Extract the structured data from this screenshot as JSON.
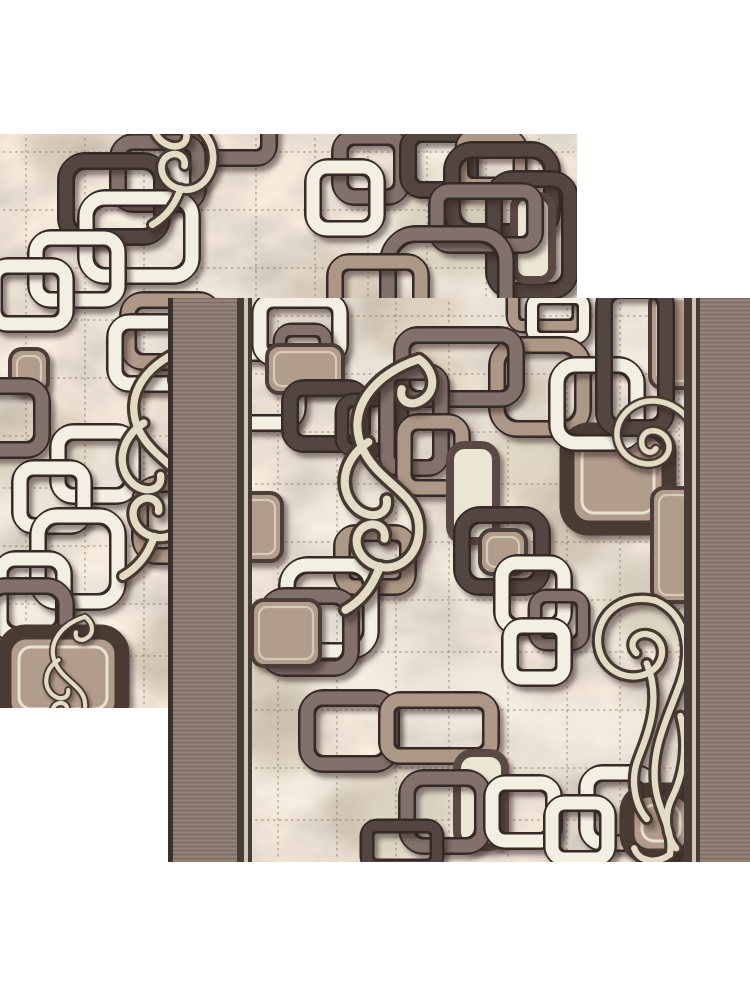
{
  "scene": {
    "description": "Product photo of a beige-brown modern carpet runner shown as two overlapping square swatches on a white background",
    "canvas": {
      "width": 750,
      "height": 1000,
      "background": "#ffffff"
    }
  },
  "palette": {
    "page_bg": "#ffffff",
    "marble_base": "#cfc4ad",
    "marble_light": "#f3efe3",
    "marble_dark": "#b5a88d",
    "grid": "#7d6c55",
    "band_base": "#8d7d74",
    "band_rib": "#7b6b63",
    "band_rib_light": "#988878",
    "edge_dark": "#3a312c",
    "sep_dark": "#473c36",
    "sep_light": "#cfc5b3",
    "outline_white": "#f3efe2",
    "outline_taupe": "#ad9887",
    "outline_grey": "#81716a",
    "outline_dark": "#53453f",
    "under_stroke": "#352c26",
    "fill_taupe": "#b29c8b",
    "fill_grey": "#9d8d80",
    "fill_cream": "#ebe5d3",
    "bigfill_border": "#493a33",
    "bigfill_inner_line": "#e9e2d0",
    "pill_border": "#5a4a42",
    "swirl_dark": "#44382f",
    "swirl_cream": "#e3dbc5",
    "shadow": "#2e241e"
  },
  "samples": [
    {
      "id": "a",
      "name": "carpet-sample-top-left",
      "x": 0,
      "y": 134,
      "w": 577,
      "h": 574,
      "seed": 11,
      "field_x": 0,
      "field_w": 577,
      "bands": null,
      "motifs": [
        {
          "t": "sq",
          "x": 195,
          "y": -28,
          "w": 74,
          "h": 52,
          "c": "g"
        },
        {
          "t": "sq",
          "x": 118,
          "y": 8,
          "w": 80,
          "h": 62,
          "c": "g"
        },
        {
          "t": "sq",
          "x": 66,
          "y": 27,
          "w": 96,
          "h": 76,
          "c": "d"
        },
        {
          "t": "sq",
          "x": 86,
          "y": 64,
          "w": 106,
          "h": 78,
          "c": "w"
        },
        {
          "t": "sq",
          "x": 36,
          "y": 104,
          "w": 82,
          "h": 62,
          "c": "w"
        },
        {
          "t": "sq",
          "x": -6,
          "y": 132,
          "w": 72,
          "h": 58,
          "c": "w"
        },
        {
          "t": "sq",
          "x": 340,
          "y": 3,
          "w": 62,
          "h": 60,
          "c": "g"
        },
        {
          "t": "sq",
          "x": 313,
          "y": 33,
          "w": 64,
          "h": 62,
          "c": "w"
        },
        {
          "t": "sq",
          "x": 408,
          "y": 0,
          "w": 62,
          "h": 56,
          "c": "d"
        },
        {
          "t": "sq",
          "x": 462,
          "y": 2,
          "w": 58,
          "h": 48,
          "c": "t"
        },
        {
          "t": "sq",
          "x": 452,
          "y": 16,
          "w": 100,
          "h": 82,
          "c": "d"
        },
        {
          "t": "sq",
          "x": 494,
          "y": 45,
          "w": 76,
          "h": 112,
          "c": "d"
        },
        {
          "t": "pl",
          "x": 514,
          "y": 62,
          "w": 38,
          "h": 84
        },
        {
          "t": "sq",
          "x": 437,
          "y": 57,
          "w": 98,
          "h": 54,
          "c": "g"
        },
        {
          "t": "sq",
          "x": 388,
          "y": 100,
          "w": 118,
          "h": 110,
          "c": "g"
        },
        {
          "t": "sq",
          "x": 335,
          "y": 128,
          "w": 86,
          "h": 58,
          "c": "t"
        },
        {
          "t": "sq",
          "x": 128,
          "y": 166,
          "w": 86,
          "h": 62,
          "c": "t"
        },
        {
          "t": "sq",
          "x": 115,
          "y": 188,
          "w": 72,
          "h": 62,
          "c": "w"
        },
        {
          "t": "fl",
          "x": 10,
          "y": 215,
          "w": 38,
          "h": 44,
          "c": "t"
        },
        {
          "t": "sq",
          "x": -30,
          "y": 252,
          "w": 72,
          "h": 64,
          "c": "g"
        },
        {
          "t": "sq",
          "x": 58,
          "y": 298,
          "w": 74,
          "h": 64,
          "c": "w"
        },
        {
          "t": "sq",
          "x": 20,
          "y": 334,
          "w": 64,
          "h": 58,
          "c": "w"
        },
        {
          "t": "sq",
          "x": 140,
          "y": 350,
          "w": 84,
          "h": 72,
          "c": "t"
        },
        {
          "t": "sq",
          "x": 38,
          "y": 382,
          "w": 80,
          "h": 86,
          "c": "w"
        },
        {
          "t": "sq",
          "x": 0,
          "y": 425,
          "w": 64,
          "h": 76,
          "c": "w"
        },
        {
          "t": "sq",
          "x": -14,
          "y": 452,
          "w": 80,
          "h": 80,
          "c": "g"
        },
        {
          "t": "bf",
          "x": 4,
          "y": 498,
          "w": 118,
          "h": 92
        }
      ],
      "swirls": [
        {
          "k": "F",
          "x": 118,
          "y": -124,
          "s": 0.95,
          "r": 0
        },
        {
          "k": "F",
          "x": 85,
          "y": 205,
          "s": 1.05,
          "r": 0
        },
        {
          "k": "F",
          "x": 25,
          "y": 478,
          "s": 0.6,
          "r": 0
        }
      ]
    },
    {
      "id": "b",
      "name": "carpet-sample-bottom-right",
      "x": 168,
      "y": 298,
      "w": 582,
      "h": 564,
      "seed": 4,
      "field_x": 84,
      "field_w": 432,
      "bands": {
        "edge_line": 5,
        "band": 64,
        "sep": [
          7,
          4,
          4
        ],
        "right_band": 50,
        "right_sep": [
          8,
          4,
          4
        ]
      },
      "motifs": [
        {
          "t": "sq",
          "x": -18,
          "y": 55,
          "w": 64,
          "h": 70,
          "c": "w"
        },
        {
          "t": "fl",
          "x": -20,
          "y": 195,
          "w": 50,
          "h": 68,
          "c": "t"
        },
        {
          "t": "sq",
          "x": 8,
          "y": 2,
          "w": 80,
          "h": 58,
          "c": "w"
        },
        {
          "t": "sq",
          "x": 28,
          "y": 32,
          "w": 46,
          "h": 46,
          "c": "g"
        },
        {
          "t": "fl",
          "x": 15,
          "y": 47,
          "w": 76,
          "h": 48,
          "c": "t"
        },
        {
          "t": "sq",
          "x": 261,
          "y": -14,
          "w": 66,
          "h": 42,
          "c": "t"
        },
        {
          "t": "sq",
          "x": 280,
          "y": 0,
          "w": 52,
          "h": 40,
          "c": "w"
        },
        {
          "t": "fl",
          "x": 398,
          "y": -6,
          "w": 46,
          "h": 96,
          "c": "t"
        },
        {
          "t": "sq",
          "x": 245,
          "y": 47,
          "w": 86,
          "h": 84,
          "c": "t"
        },
        {
          "t": "bf",
          "x": 315,
          "y": 132,
          "w": 102,
          "h": 98
        },
        {
          "t": "sq",
          "x": 305,
          "y": 67,
          "w": 80,
          "h": 78,
          "c": "w"
        },
        {
          "t": "sq",
          "x": 352,
          "y": -8,
          "w": 62,
          "h": 138,
          "c": "d"
        },
        {
          "t": "sq",
          "x": 38,
          "y": 90,
          "w": 72,
          "h": 56,
          "c": "d"
        },
        {
          "t": "sq",
          "x": 90,
          "y": 102,
          "w": 60,
          "h": 50,
          "c": "d"
        },
        {
          "t": "sq",
          "x": 150,
          "y": 37,
          "w": 114,
          "h": 64,
          "c": "g"
        },
        {
          "t": "sq",
          "x": 135,
          "y": 74,
          "w": 54,
          "h": 96,
          "c": "g"
        },
        {
          "t": "sq",
          "x": 152,
          "y": 124,
          "w": 58,
          "h": 66,
          "c": "t"
        },
        {
          "t": "pl",
          "x": 198,
          "y": 147,
          "w": 46,
          "h": 96
        },
        {
          "t": "sq",
          "x": 210,
          "y": 217,
          "w": 80,
          "h": 72,
          "c": "d"
        },
        {
          "t": "fl",
          "x": 228,
          "y": 232,
          "w": 46,
          "h": 44,
          "c": "t"
        },
        {
          "t": "sq",
          "x": 250,
          "y": 265,
          "w": 62,
          "h": 64,
          "c": "w"
        },
        {
          "t": "sq",
          "x": 283,
          "y": 298,
          "w": 48,
          "h": 48,
          "c": "g"
        },
        {
          "t": "sq",
          "x": 258,
          "y": 328,
          "w": 54,
          "h": 52,
          "c": "w"
        },
        {
          "t": "sq",
          "x": 90,
          "y": 235,
          "w": 66,
          "h": 54,
          "c": "t"
        },
        {
          "t": "sq",
          "x": 35,
          "y": 267,
          "w": 84,
          "h": 86,
          "c": "w"
        },
        {
          "t": "sq",
          "x": 15,
          "y": 298,
          "w": 84,
          "h": 72,
          "c": "g"
        },
        {
          "t": "fl",
          "x": 0,
          "y": 302,
          "w": 68,
          "h": 66,
          "c": "t"
        },
        {
          "t": "fl",
          "x": 400,
          "y": 190,
          "w": 44,
          "h": 114,
          "c": "t"
        },
        {
          "t": "sq",
          "x": 55,
          "y": 400,
          "w": 84,
          "h": 66,
          "c": "g"
        },
        {
          "t": "sq",
          "x": 135,
          "y": 402,
          "w": 104,
          "h": 56,
          "c": "t"
        },
        {
          "t": "pl",
          "x": 205,
          "y": 455,
          "w": 48,
          "h": 94
        },
        {
          "t": "sq",
          "x": 155,
          "y": 480,
          "w": 76,
          "h": 68,
          "c": "g"
        },
        {
          "t": "sq",
          "x": 240,
          "y": 485,
          "w": 62,
          "h": 58,
          "c": "w"
        },
        {
          "t": "sq",
          "x": 115,
          "y": 528,
          "w": 70,
          "h": 40,
          "c": "d"
        },
        {
          "t": "sq",
          "x": 335,
          "y": 475,
          "w": 64,
          "h": 70,
          "c": "w"
        },
        {
          "t": "sq",
          "x": 300,
          "y": 505,
          "w": 56,
          "h": 56,
          "c": "w"
        },
        {
          "t": "bf",
          "x": 375,
          "y": 492,
          "w": 68,
          "h": 66
        }
      ],
      "swirls": [
        {
          "k": "F",
          "x": 52,
          "y": 52,
          "s": 1.15,
          "r": 0
        },
        {
          "k": "S",
          "x": 372,
          "y": 84,
          "s": 0.85,
          "r": 20
        },
        {
          "k": "T",
          "x": 336,
          "y": 292,
          "s": 1.05,
          "r": 0
        }
      ]
    }
  ],
  "grid": {
    "spacing_x": 57,
    "spacing_y": 56,
    "dash": "2.5 3.5",
    "opacity": 0.5,
    "stroke_width": 1.5
  }
}
